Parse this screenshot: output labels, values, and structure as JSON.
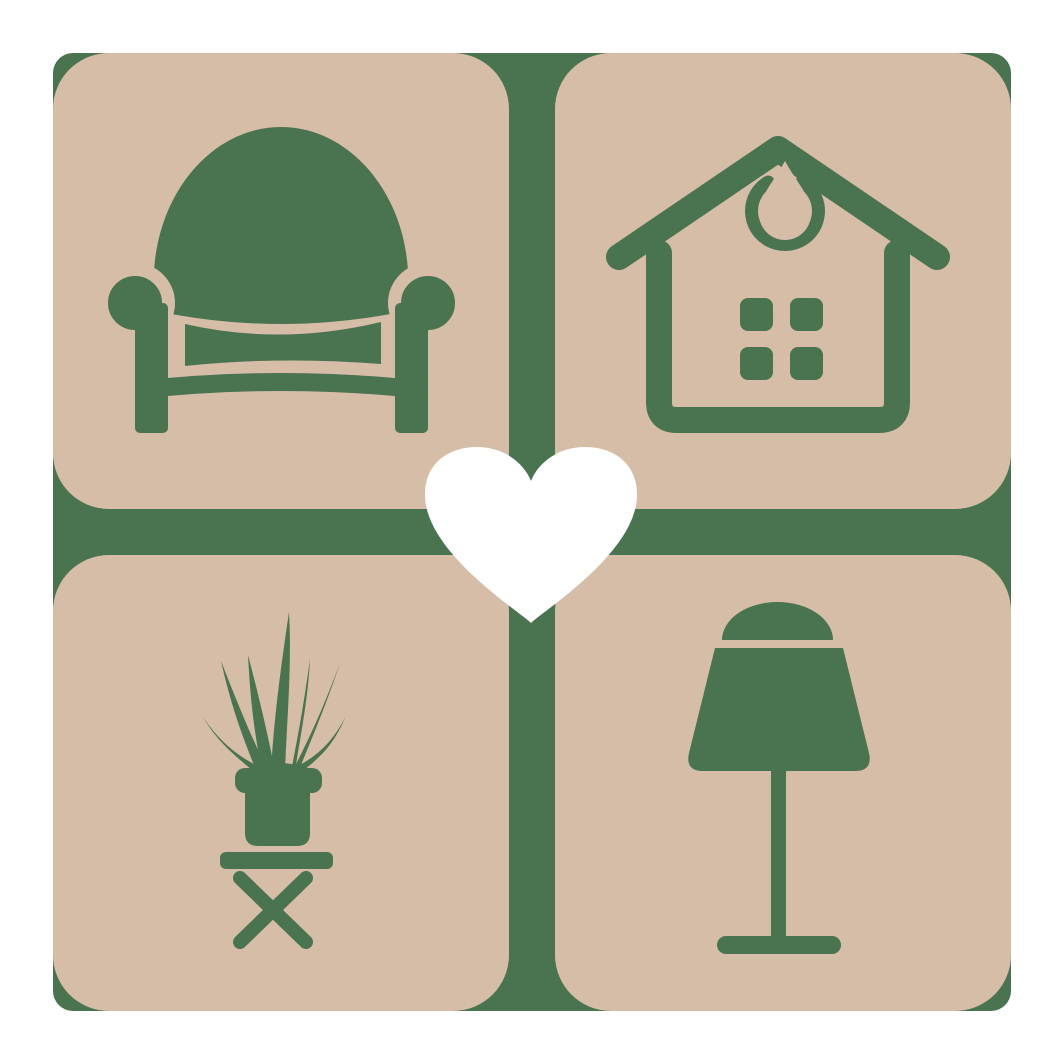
{
  "logo": {
    "description": "Home decor brand logo: four rounded square tiles in a 2x2 grid on a green backdrop, each tile showing a furniture icon, with a white heart at the center",
    "colors": {
      "background": "#FFFFFF",
      "backdrop": "#4A734F",
      "tile": "#D6BDA8",
      "icon": "#4A734F",
      "heart": "#FFFFFF"
    },
    "tiles": [
      {
        "position": "top-left",
        "icon": "armchair-icon",
        "label": "armchair"
      },
      {
        "position": "top-right",
        "icon": "house-icon",
        "label": "house with ornament and window"
      },
      {
        "position": "bottom-left",
        "icon": "potted-plant-icon",
        "label": "potted plant on folding side table"
      },
      {
        "position": "bottom-right",
        "icon": "table-lamp-icon",
        "label": "table lamp"
      }
    ],
    "center": {
      "icon": "heart-icon",
      "label": "heart"
    }
  }
}
